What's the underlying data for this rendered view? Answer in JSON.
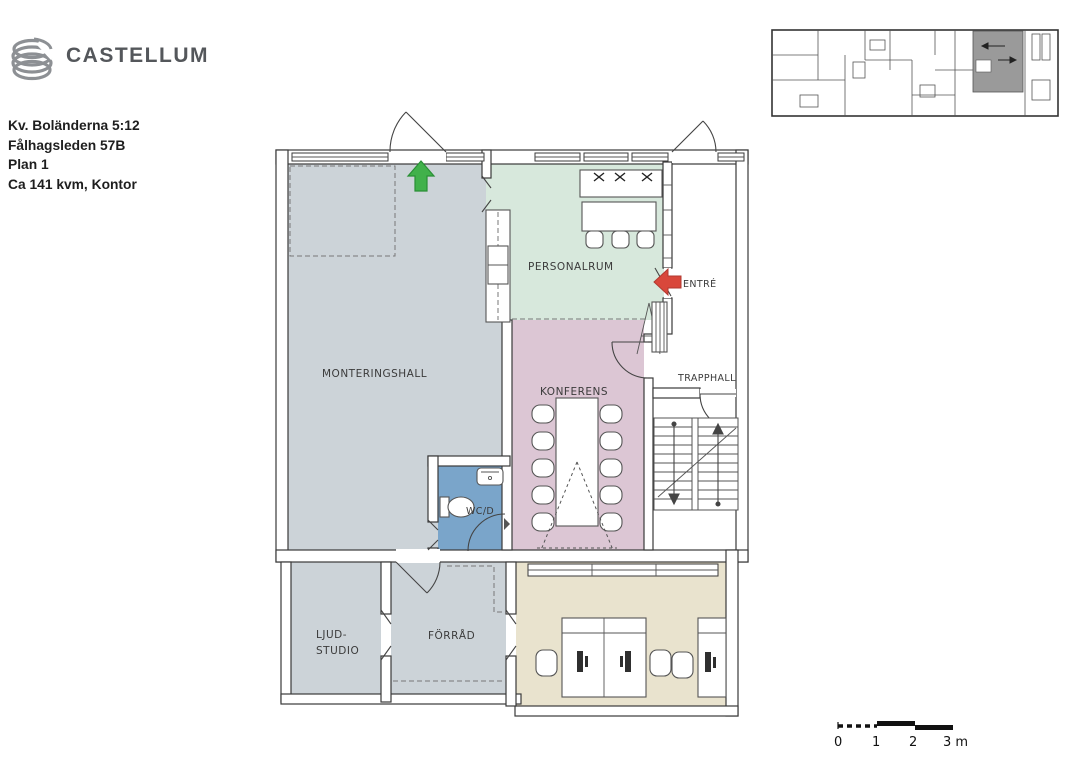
{
  "header": {
    "brand": "CASTELLUM",
    "info_line1": "Kv. Boländerna 5:12",
    "info_line2": "Fålhagsleden 57B",
    "info_line3": "Plan 1",
    "info_line4": "Ca 141 kvm, Kontor"
  },
  "floorplan": {
    "labels": {
      "monteringshall": "MONTERINGSHALL",
      "personalrum": "PERSONALRUM",
      "konferens": "KONFERENS",
      "trapphall": "TRAPPHALL",
      "wc": "WC/D",
      "ljudstudio_line1": "LJUD-",
      "ljudstudio_line2": "STUDIO",
      "forrad": "FÖRRÅD",
      "entre": "ENTRÉ"
    },
    "colors": {
      "hall_gray": "#ccd3d8",
      "personalrum_green": "#d7e8dc",
      "konferens_pink": "#dcc6d4",
      "wc_blue": "#7aa5ca",
      "office_beige": "#e9e3ce",
      "entry_arrow_red": "#d9473b",
      "north_arrow_green": "#41b14b",
      "overview_highlight_gray": "#9a9a9a"
    }
  },
  "scalebar": {
    "tick0": "0",
    "tick1": "1",
    "tick2": "2",
    "tick3": "3 m"
  }
}
